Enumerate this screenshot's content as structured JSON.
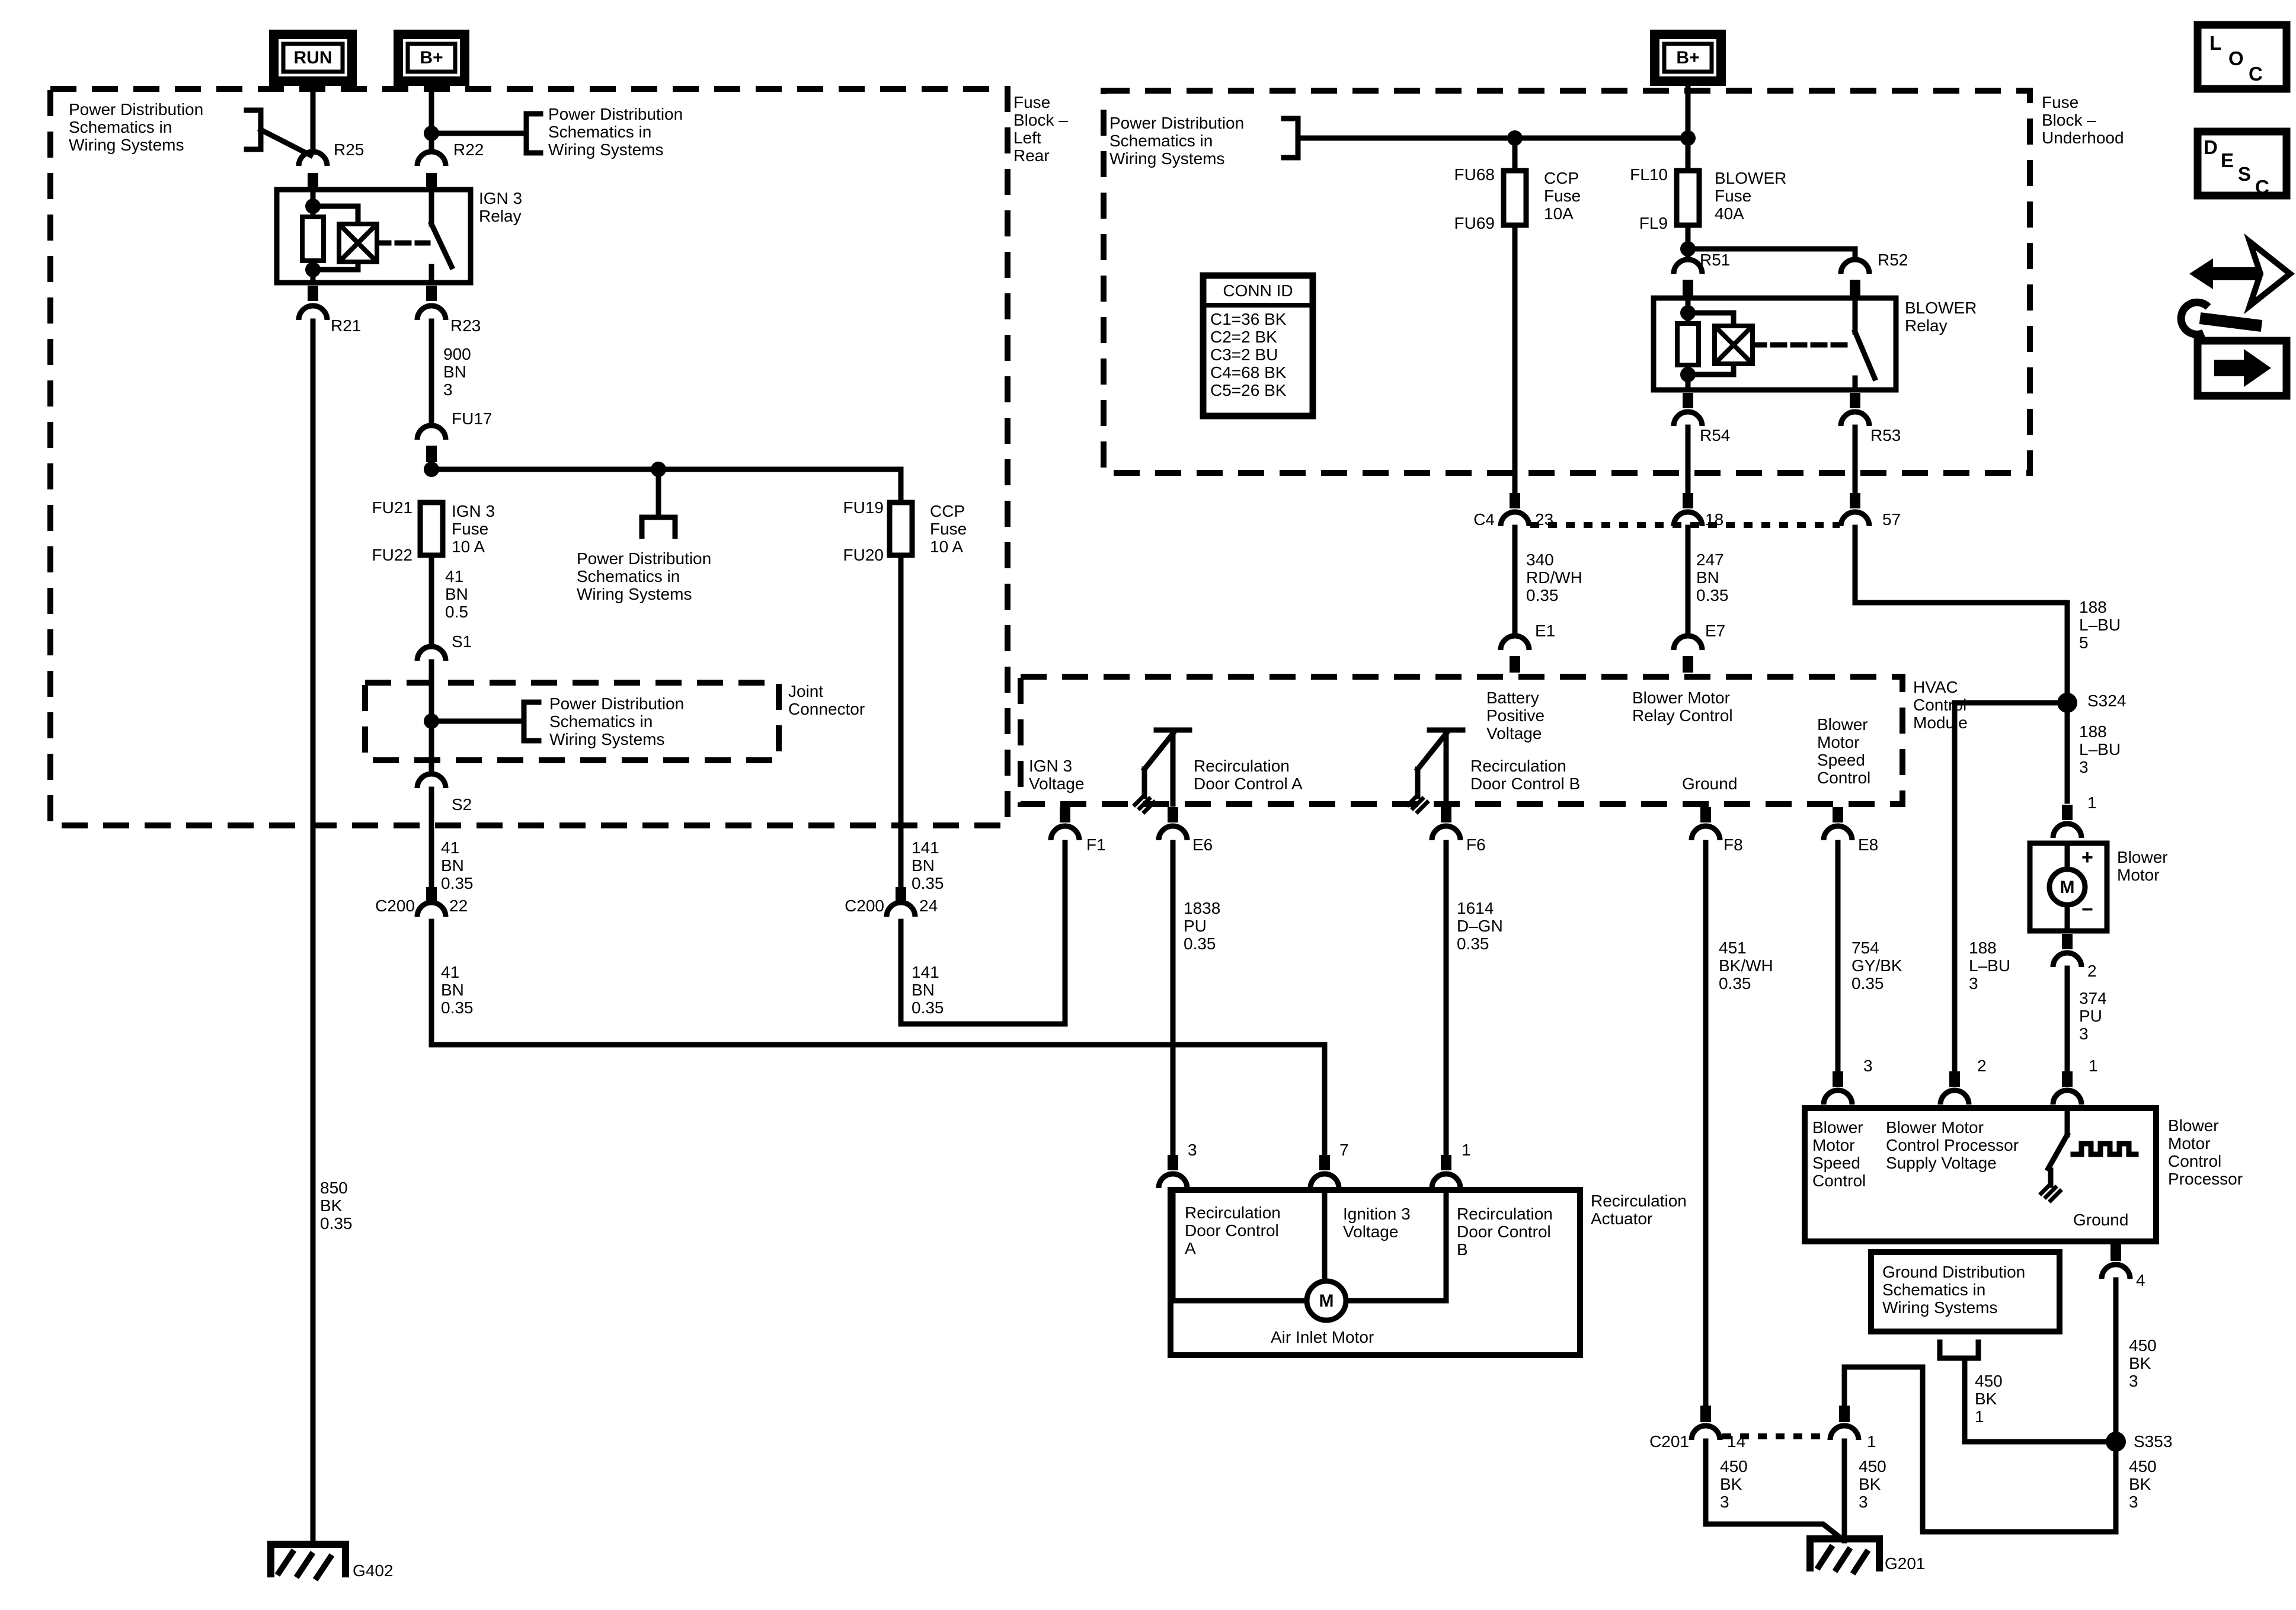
{
  "colors": {
    "ink": "#000000",
    "background": "#ffffff"
  },
  "terminals": {
    "run": "RUN",
    "bplus": "B+"
  },
  "icons": {
    "loc": "LOC",
    "desc": "DESC"
  },
  "refs": {
    "pds": "Power Distribution\nSchematics in\nWiring Systems",
    "gds": "Ground Distribution\nSchematics in\nWiring Systems",
    "fuse_block_left_rear": "Fuse\nBlock –\nLeft\nRear",
    "fuse_block_underhood": "Fuse\nBlock –\nUnderhood",
    "joint_connector": "Joint\nConnector",
    "hvac_module": "HVAC\nControl\nModule",
    "recirc_actuator": "Recirculation\nActuator",
    "air_inlet_motor": "Air Inlet Motor",
    "blower_motor": "Blower\nMotor",
    "bmcp": "Blower\nMotor\nControl\nProcessor",
    "ign3_relay": "IGN 3\nRelay",
    "blower_relay": "BLOWER\nRelay"
  },
  "conn_id": {
    "title": "CONN ID",
    "rows": "C1=36 BK\nC2=2 BK\nC3=2 BU\nC4=68 BK\nC5=26 BK"
  },
  "fuses": {
    "ign3_fuse": "IGN 3\nFuse\n10 A",
    "ccp_fuse": "CCP\nFuse\n10 A",
    "ccp_fuse2": "CCP\nFuse\n10A",
    "blower_fuse": "BLOWER\nFuse\n40A"
  },
  "ids": {
    "r25": "R25",
    "r22": "R22",
    "r21": "R21",
    "r23": "R23",
    "fu17": "FU17",
    "fu21": "FU21",
    "fu22": "FU22",
    "fu19": "FU19",
    "fu20": "FU20",
    "fu68": "FU68",
    "fu69": "FU69",
    "fl10": "FL10",
    "fl9": "FL9",
    "r51": "R51",
    "r52": "R52",
    "r54": "R54",
    "r53": "R53",
    "s1": "S1",
    "s2": "S2",
    "s324": "S324",
    "s353": "S353",
    "c200": "C200",
    "c201": "C201",
    "c4": "C4",
    "e1": "E1",
    "e7": "E7",
    "f1": "F1",
    "e6": "E6",
    "f6": "F6",
    "f8": "F8",
    "e8": "E8",
    "g402": "G402",
    "g201": "G201"
  },
  "pin_numbers": {
    "p22": "22",
    "p24": "24",
    "p23": "23",
    "p18": "18",
    "p57": "57",
    "p3": "3",
    "p7": "7",
    "p1": "1",
    "p2": "2",
    "p4": "4",
    "p14": "14"
  },
  "wires": {
    "w900": "900\nBN\n3",
    "w41_05": "41\nBN\n0.5",
    "w41_035": "41\nBN\n0.35",
    "w141": "141\nBN\n0.35",
    "w850": "850\nBK\n0.35",
    "w340": "340\nRD/WH\n0.35",
    "w247": "247\nBN\n0.35",
    "w188_5": "188\nL–BU\n5",
    "w188_3": "188\nL–BU\n3",
    "w1838": "1838\nPU\n0.35",
    "w1614": "1614\nD–GN\n0.35",
    "w451": "451\nBK/WH\n0.35",
    "w754": "754\nGY/BK\n0.35",
    "w374": "374\nPU\n3",
    "w450_3": "450\nBK\n3",
    "w450_1": "450\nBK\n1"
  },
  "hvac": {
    "ign3_voltage": "IGN 3\nVoltage",
    "rdc_a": "Recirculation\nDoor Control A",
    "rdc_b": "Recirculation\nDoor Control B",
    "battery": "Battery\nPositive\nVoltage",
    "relay_control": "Blower Motor\nRelay Control",
    "ground": "Ground",
    "speed_control": "Blower\nMotor\nSpeed\nControl"
  },
  "actuator": {
    "rdc_a": "Recirculation\nDoor Control\nA",
    "ign3_voltage": "Ignition 3\nVoltage",
    "rdc_b": "Recirculation\nDoor Control\nB"
  },
  "processor": {
    "supply": "Blower Motor\nControl Processor\nSupply Voltage",
    "ground": "Ground"
  },
  "misc": {
    "motor": "M",
    "plus": "+",
    "minus": "−"
  }
}
